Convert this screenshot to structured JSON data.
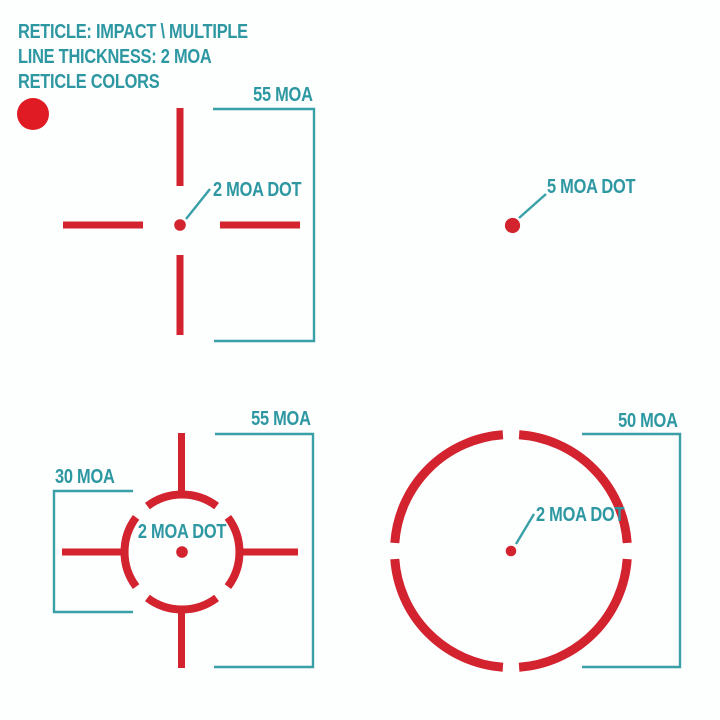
{
  "header": {
    "line1": "RETICLE: IMPACT \\ MULTIPLE",
    "line2": "LINE THICKNESS: 2 MOA",
    "line3": "RETICLE COLORS"
  },
  "reticles": {
    "crosshair": {
      "bracket_label": "55 MOA",
      "dot_label": "2 MOA DOT"
    },
    "dot_only": {
      "dot_label": "5 MOA DOT"
    },
    "circle_crosshair": {
      "bracket_right_label": "55 MOA",
      "bracket_left_label": "30 MOA",
      "dot_label": "2 MOA DOT"
    },
    "circle": {
      "bracket_label": "50 MOA",
      "dot_label": "2 MOA DOT"
    }
  },
  "colors": {
    "reticle_red": "#d2232e",
    "swatch_red": "#e01b24",
    "teal_text": "#2d97a2",
    "teal_line": "#3aa0a8",
    "background": "#fdfefe"
  }
}
